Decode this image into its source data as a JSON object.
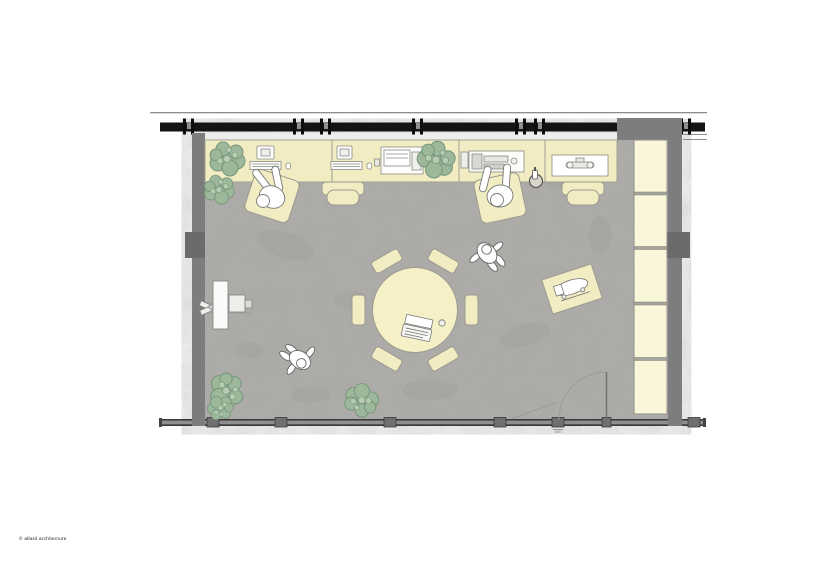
{
  "credit": "© allard architecture",
  "drawing": {
    "type": "architectural floor plan",
    "view": "top-down open office / studio",
    "colors": {
      "background": "#ffffff",
      "floor_concrete": "#b5b3b0",
      "furniture_cream": "#f2ecc2",
      "shelf_cream": "#faf6da",
      "wall_gray": "#7d7d7d",
      "pilaster_gray": "#6b6b6b",
      "window_frame_black": "#141414",
      "plant_green": "#9cb79a",
      "outline_gray": "#9a9a90"
    },
    "inventory": {
      "desk_sections": 5,
      "desk_chairs_empty": 2,
      "people_seated_at_desks": 2,
      "people_walking": 2,
      "meeting_table": {
        "shape": "round",
        "chairs": 6,
        "items": [
          "laptop",
          "cup"
        ]
      },
      "shelf_compartments": 5,
      "plant_clusters": 6,
      "desk_equipment": [
        "monitor and keyboard",
        "monitor and keyboard",
        "printer-copier",
        "workstation machine",
        "drawing board with tool"
      ],
      "side_table_with_machine": 1,
      "floor_standing_equipment": 1,
      "door": "single swing leaf, bottom-right"
    }
  }
}
